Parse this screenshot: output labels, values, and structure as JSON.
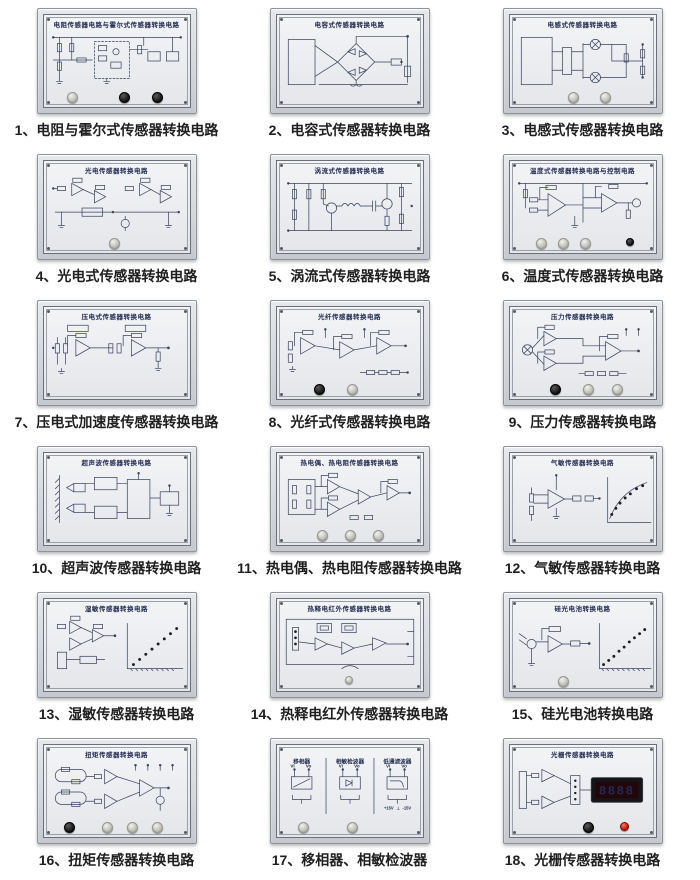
{
  "colors": {
    "page_background": "#ffffff",
    "panel_title_text": "#232c52",
    "schematic_lines": "#39425f",
    "caption_text": "#1f1f1f",
    "display_digits": "#ff2218"
  },
  "panels": [
    {
      "caption": "1、电阻与霍尔式传感器转换电路",
      "title": "电阻传感器电路与霍尔式传感器转换电路"
    },
    {
      "caption": "2、电容式传感器转换电路",
      "title": "电容式传感器转换电路"
    },
    {
      "caption": "3、电感式传感器转换电路",
      "title": "电感式传感器转换电路"
    },
    {
      "caption": "4、光电式传感器转换电路",
      "title": "光电传感器转换电路"
    },
    {
      "caption": "5、涡流式传感器转换电路",
      "title": "涡流式传感器转换电路"
    },
    {
      "caption": "6、温度式传感器转换电路",
      "title": "温度式传感器转换电路与控制电路"
    },
    {
      "caption": "7、压电式加速度传感器转换电路",
      "title": "压电式传感器转换电路"
    },
    {
      "caption": "8、光纤式传感器转换电路",
      "title": "光纤传感器转换电路"
    },
    {
      "caption": "9、压力传感器转换电路",
      "title": "压力传感器转换电路"
    },
    {
      "caption": "10、超声波传感器转换电路",
      "title": "超声波传感器转换电路"
    },
    {
      "caption": "11、热电偶、热电阻传感器转换电路",
      "title": "热电偶、热电阻传感器转换电路"
    },
    {
      "caption": "12、气敏传感器转换电路",
      "title": "气敏传感器转换电路"
    },
    {
      "caption": "13、湿敏传感器转换电路",
      "title": "湿敏传感器转换电路"
    },
    {
      "caption": "14、热释电红外传感器转换电路",
      "title": "热释电红外传感器转换电路"
    },
    {
      "caption": "15、硅光电池转换电路",
      "title": "硅光电池转换电路"
    },
    {
      "caption": "16、扭矩传感器转换电路",
      "title": "扭矩传感器转换电路"
    },
    {
      "caption": "17、移相器、相敏检波器",
      "sections": [
        {
          "title": "移相器",
          "in_label": "Vi",
          "out_label": "Vo"
        },
        {
          "title": "相敏检波器",
          "in_label": "Vi",
          "out_label": "Vo"
        },
        {
          "title": "低通滤波器",
          "in_label": "Vi",
          "out_label": "Vo"
        }
      ],
      "power_labels": {
        "pos": "+15V",
        "gnd": "⊥",
        "neg": "-15V"
      }
    },
    {
      "caption": "18、光栅传感器转换电路",
      "title": "光栅传感器转换电路",
      "display_value": "8888"
    }
  ]
}
